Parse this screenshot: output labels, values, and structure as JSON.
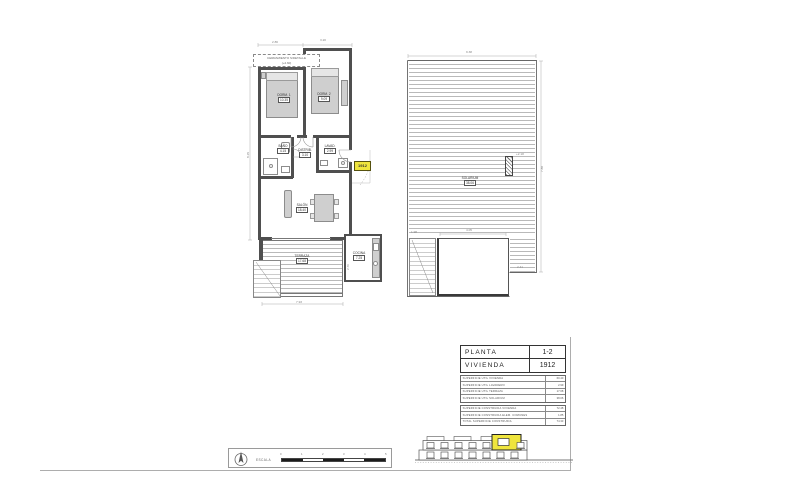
{
  "colors": {
    "wall": "#4f4f4f",
    "furniture_fill": "#cfcfcf",
    "deck_line": "#b9b9b9",
    "highlight": "#efe53d",
    "hairline": "#adadad"
  },
  "plan1": {
    "annotation": [
      "CERRAMIENTO S/DETALLE",
      "(+2.60)"
    ],
    "unit_badge": "1912",
    "rooms": {
      "dorm1": {
        "name": "DORM. 1",
        "area": "10.35"
      },
      "dorm2": {
        "name": "DORM. 2",
        "area": "9.09"
      },
      "salon": {
        "name": "SALÓN",
        "area": "18.40"
      },
      "bano": {
        "name": "BAÑO",
        "area": "4.15"
      },
      "distrib": {
        "name": "DISTRIB.",
        "area": "3.10"
      },
      "lavadero": {
        "name": "LAVAD.",
        "area": "2.99"
      },
      "cocina": {
        "name": "COCINA",
        "area": "7.25"
      },
      "terraza": {
        "name": "TERRAZA",
        "area": "17.68"
      }
    },
    "dims": [
      "2.86",
      "3.20",
      "8.15",
      "7.93",
      "2.70"
    ]
  },
  "plan2": {
    "rooms": {
      "solarium": {
        "name": "SOLARIUM",
        "area": "38.06"
      }
    },
    "level_note": "+2.18",
    "dims": [
      "9.38",
      "7.88",
      "4.05",
      "2.41",
      "1.98"
    ]
  },
  "title_block": {
    "main": [
      {
        "label": "PLANTA",
        "value": "1-2"
      },
      {
        "label": "VIVIENDA",
        "value": "1912"
      }
    ],
    "superficies_utiles": [
      {
        "label": "SUPERFICIE ÚTIL VIVIENDA",
        "value": "60.40"
      },
      {
        "label": "SUPERFICIE ÚTIL LAVADERO",
        "value": "2.99"
      },
      {
        "label": "SUPERFICIE ÚTIL TERRAZA",
        "value": "17.68"
      },
      {
        "label": "SUPERFICIE ÚTIL SOLARIUM",
        "value": "38.06"
      }
    ],
    "superficies_construidas": [
      {
        "label": "SUPERFICIE CONSTRUIDA VIVIENDA",
        "value": "72.48"
      },
      {
        "label": "SUPERFICIE CONSTRUIDA ELEM. COMUNES",
        "value": "1.85"
      },
      {
        "label": "TOTAL SUPERFICIE CONSTRUIDA",
        "value": "74.33"
      }
    ]
  },
  "scale_bar": {
    "label": "ESCALA",
    "ticks": [
      "0",
      "1",
      "2",
      "3",
      "4",
      "5"
    ]
  }
}
